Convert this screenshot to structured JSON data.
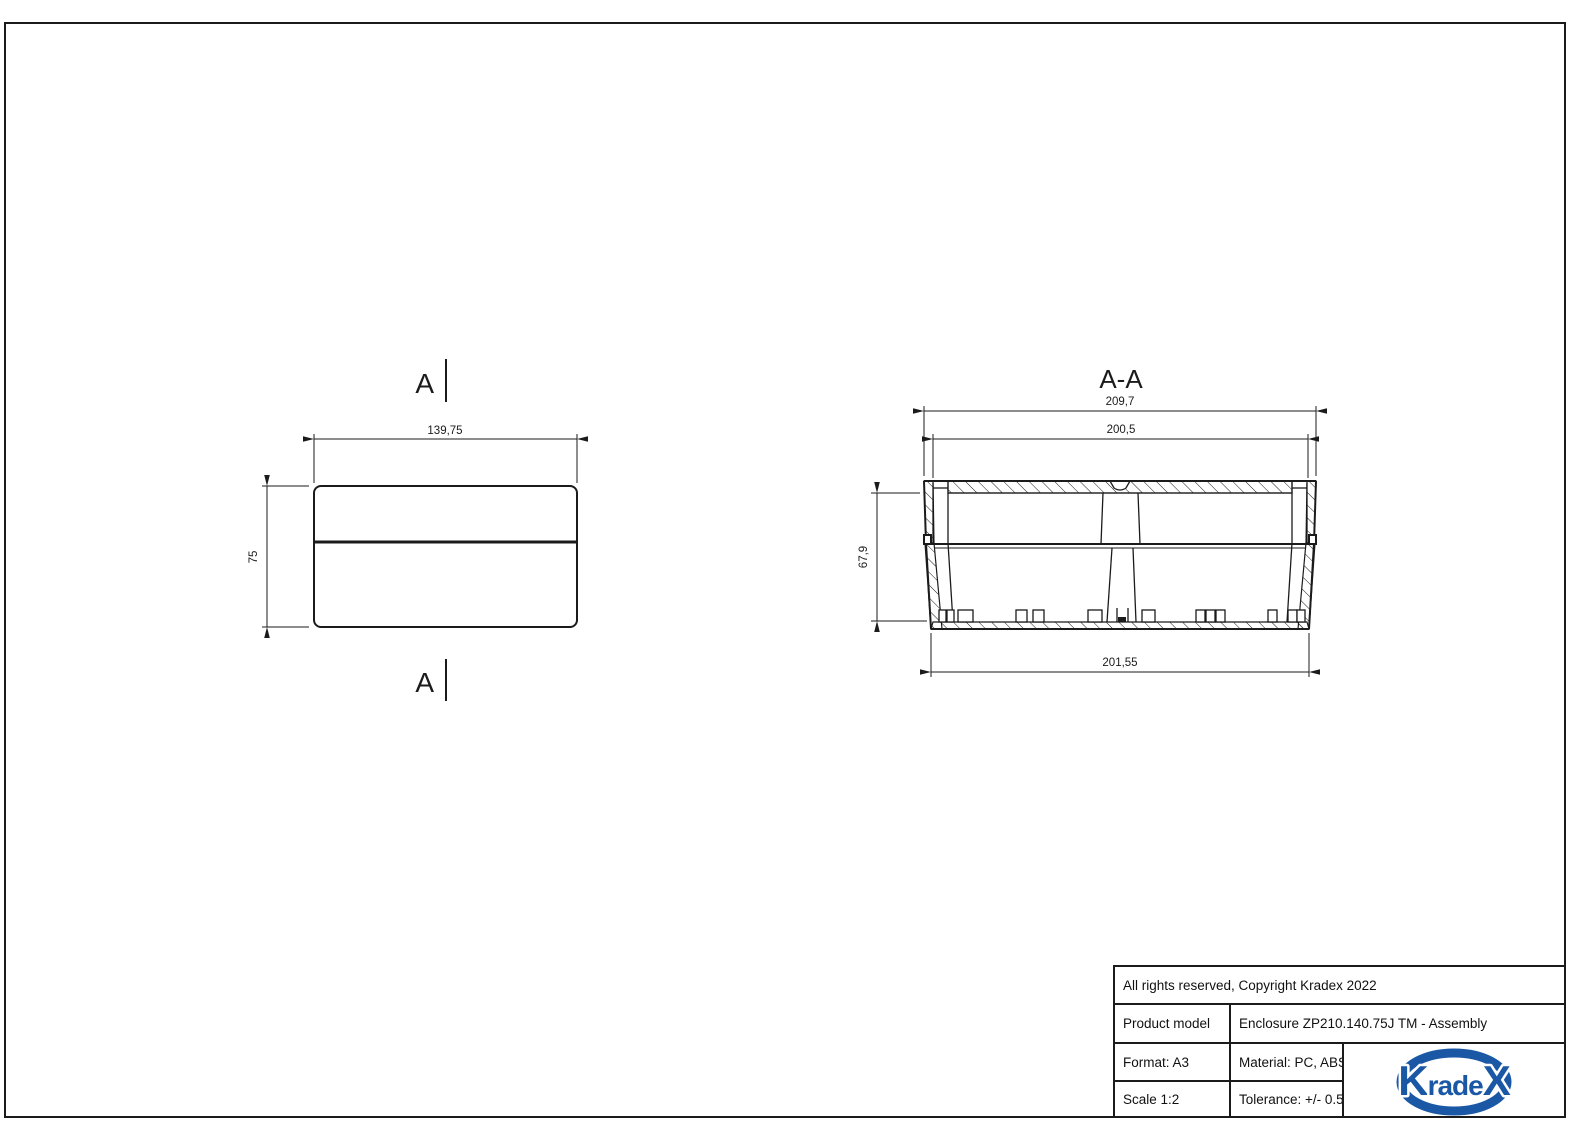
{
  "colors": {
    "ink": "#1b1b1b",
    "logo_blue": "#1a57a5"
  },
  "drawing": {
    "side_view": {
      "section_label": "A",
      "width_dim": "139,75",
      "height_dim": "75"
    },
    "section_view": {
      "title": "A-A",
      "overall_width_dim": "209,7",
      "lid_inner_width_dim": "200,5",
      "inner_height_dim": "67,9",
      "base_width_dim": "201,55"
    }
  },
  "title_block": {
    "copyright": "All rights reserved, Copyright Kradex 2022",
    "product_model_label": "Product model",
    "product_model_value": "Enclosure ZP210.140.75J TM - Assembly",
    "format": "Format: A3",
    "material": "Material: PC, ABS",
    "scale": "Scale 1:2",
    "tolerance": "Tolerance: +/- 0.5",
    "logo": {
      "part1": "K",
      "part2": "rade",
      "part3": "X"
    }
  }
}
